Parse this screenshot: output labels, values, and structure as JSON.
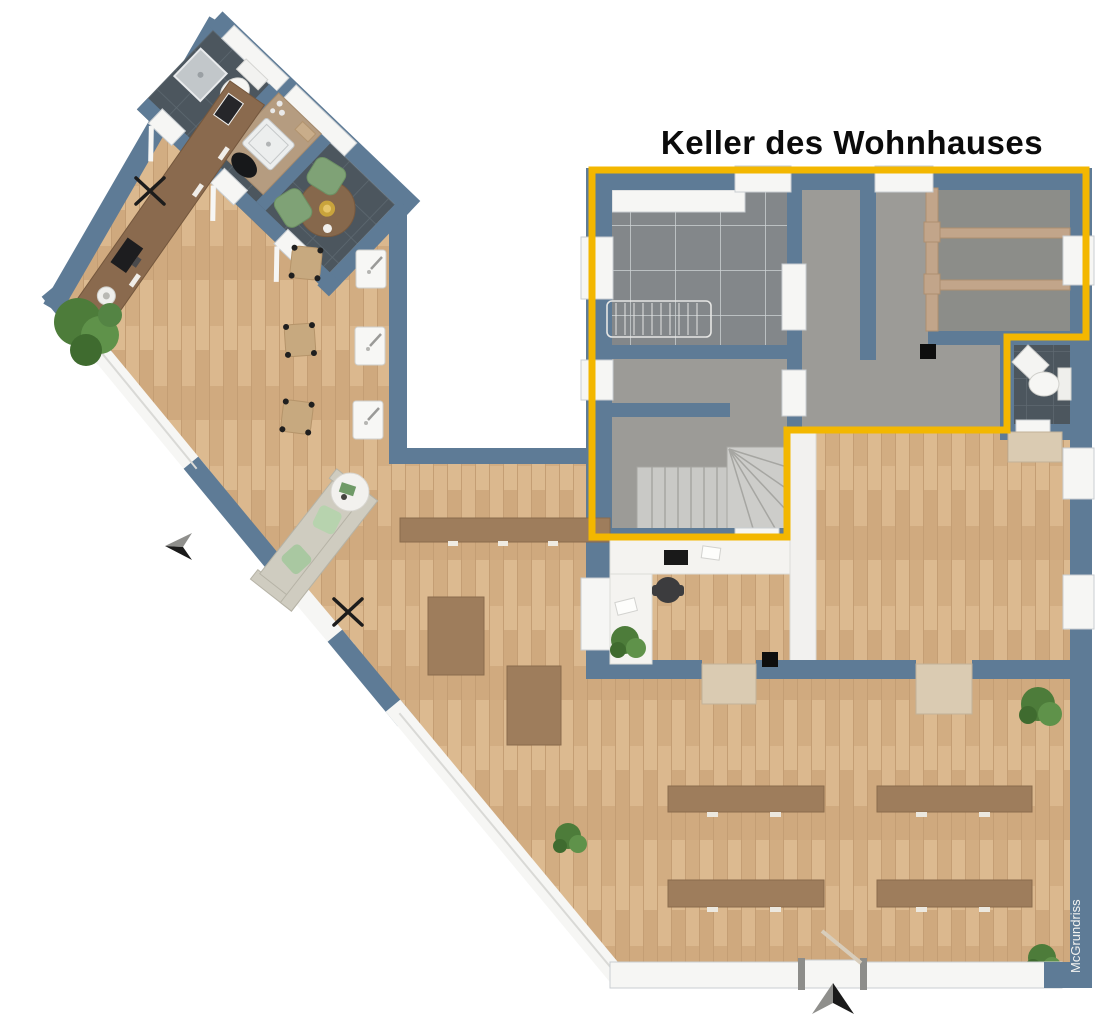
{
  "title": "Keller des Wohnhauses",
  "watermark": "McGrundriss",
  "palette": {
    "wall_blue": "#5e7b96",
    "highlight_yellow": "#F3B700",
    "wood_floor": "#d6b286",
    "concrete_floor": "#9c9b97",
    "storage_floor": "#8c8d89",
    "dark_tile": "#4c565e",
    "laundry_tile": "#83878a",
    "desk_wood": "#8a6a4e",
    "table_wood": "#9e7d5c",
    "partition_wood": "#c2a58a",
    "sofa_beige": "#cfccc0",
    "chair_green": "#7fa276",
    "plant_green": "#4d7c3a",
    "window_white": "#f6f6f4",
    "door_beige": "#dacbb2"
  }
}
